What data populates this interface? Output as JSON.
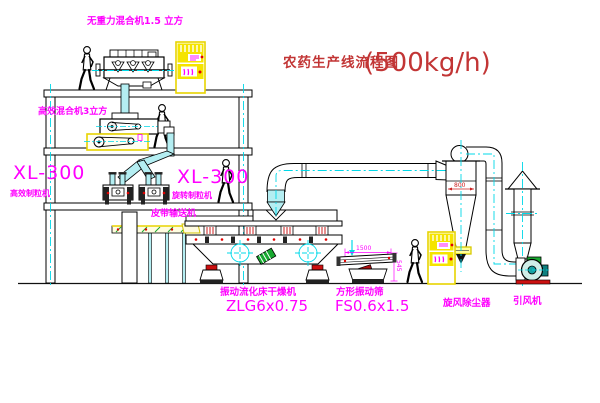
{
  "title": {
    "text": "农药生产线流程图",
    "capacity": "(500kg/h)"
  },
  "equipment": {
    "gravity_mixer": {
      "label": "无重力混合机1.5 立方"
    },
    "high_eff_mixer": {
      "label": "高效混合机3立方"
    },
    "granulator_left": {
      "model": "XL-300",
      "name": "高效制粒机"
    },
    "granulator_right": {
      "model": "XL-300",
      "name": "旋转制粒机"
    },
    "belt_conveyor": {
      "label": "皮带输送机"
    },
    "fluid_bed_dryer": {
      "name": "振动流化床干燥机",
      "model": "ZLG6x0.75"
    },
    "vibrating_screen": {
      "name": "方形振动筛",
      "model": "FS0.6x1.5",
      "dim_length": "1500",
      "dim_height": "545"
    },
    "cyclone": {
      "label": "旋风除尘器",
      "dim_width": "800"
    },
    "draft_fan": {
      "label": "引风机"
    }
  },
  "colors": {
    "label_magenta": "#ff00ff",
    "title_red": "#c23535",
    "cabinet_yellow": "#f5e400",
    "pipe_cyan": "#b4eef2",
    "centerline_cyan": "#00d8e8",
    "machine_green": "#18a830",
    "alert_red": "#e00000"
  }
}
